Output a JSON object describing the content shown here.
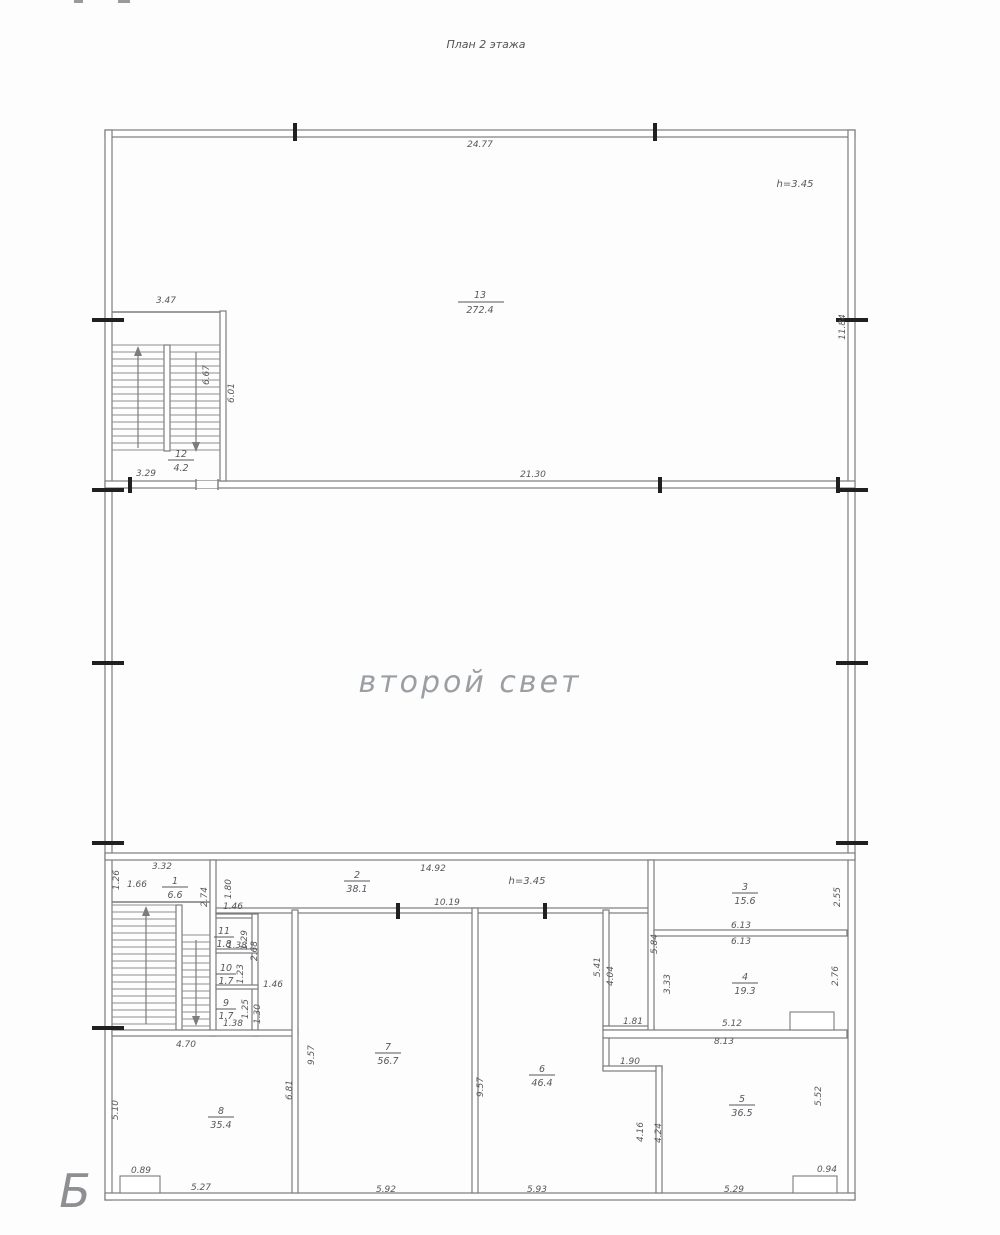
{
  "page": {
    "title": "План 2 этажа",
    "axis_label": "Б",
    "void_label": "второй свет"
  },
  "heights": {
    "upper": "h=3.45",
    "lower": "h=3.45"
  },
  "rooms": {
    "r1": {
      "num": "1",
      "area": "6.6"
    },
    "r2": {
      "num": "2",
      "area": "38.1"
    },
    "r3": {
      "num": "3",
      "area": "15.6"
    },
    "r4": {
      "num": "4",
      "area": "19.3"
    },
    "r5": {
      "num": "5",
      "area": "36.5"
    },
    "r6": {
      "num": "6",
      "area": "46.4"
    },
    "r7": {
      "num": "7",
      "area": "56.7"
    },
    "r8": {
      "num": "8",
      "area": "35.4"
    },
    "r9": {
      "num": "9",
      "area": "1.7"
    },
    "r10": {
      "num": "10",
      "area": "1.7"
    },
    "r11": {
      "num": "11",
      "area": "1.8"
    },
    "r12": {
      "num": "12",
      "area": "4.2"
    },
    "r13": {
      "num": "13",
      "area": "272.4"
    }
  },
  "dims": {
    "top_width": "24.77",
    "mid_width": "21.30",
    "right_wall": "11.84",
    "stair_width": "3.47",
    "stair_run": "6.67",
    "stair_depth": "6.01",
    "stair_bottom": "3.29",
    "block_left": "3.32",
    "d126": "1.26",
    "d166": "1.66",
    "d274": "2.74",
    "d180": "1.80",
    "d146a": "1.46",
    "d138a": "1.38",
    "d129": "1.29",
    "d268": "2.68",
    "d123": "1.23",
    "d146b": "1.46",
    "d138b": "1.38",
    "d125": "1.25",
    "d130": "1.30",
    "room2_w": "14.92",
    "corridor": "10.19",
    "d584": "5.84",
    "d255": "2.55",
    "d613a": "6.13",
    "d613b": "6.13",
    "d333": "3.33",
    "d276": "2.76",
    "d512": "5.12",
    "d813": "8.13",
    "d181": "1.81",
    "d190": "1.90",
    "d416": "4.16",
    "d424": "4.24",
    "d541": "5.41",
    "d404": "4.04",
    "d957a": "9.57",
    "d957b": "9.57",
    "d681": "6.81",
    "d510": "5.10",
    "d470": "4.70",
    "d552": "5.52",
    "d089": "0.89",
    "d094": "0.94",
    "bottom1": "5.27",
    "bottom2": "5.92",
    "bottom3": "5.93",
    "bottom4": "5.29"
  }
}
